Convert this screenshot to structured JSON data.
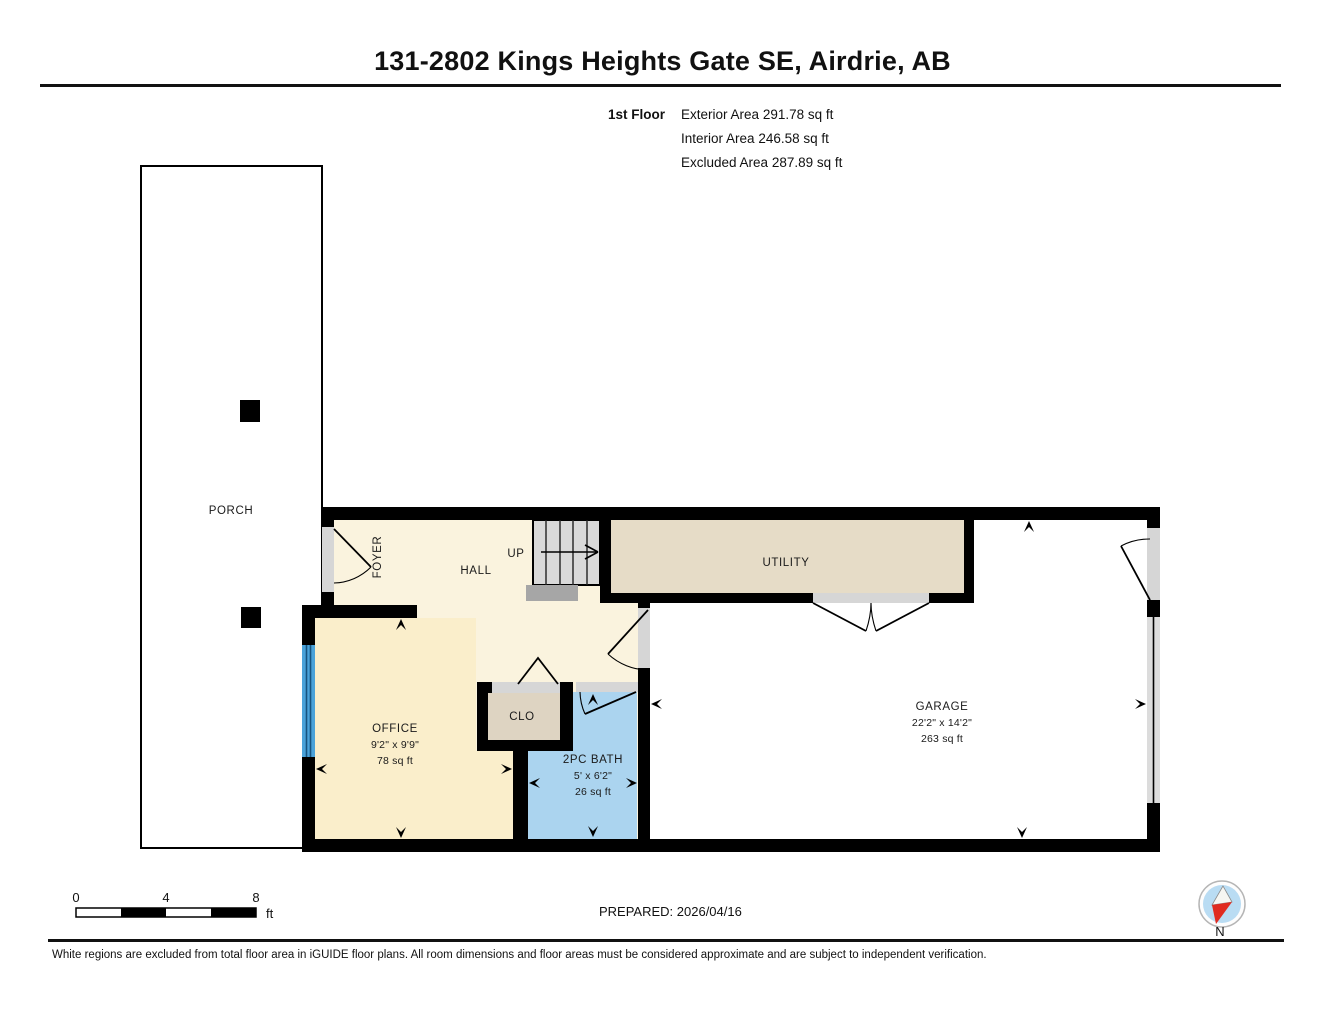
{
  "header": {
    "title": "131-2802 Kings Heights Gate SE, Airdrie, AB",
    "floor_label": "1st Floor",
    "areas": [
      {
        "label": "Exterior Area",
        "value": "291.78 sq ft"
      },
      {
        "label": "Interior Area",
        "value": "246.58 sq ft"
      },
      {
        "label": "Excluded Area",
        "value": "287.89 sq ft"
      }
    ]
  },
  "rooms": {
    "porch": {
      "name": "PORCH"
    },
    "foyer": {
      "name": "FOYER"
    },
    "hall": {
      "name": "HALL"
    },
    "stairs": {
      "direction": "UP"
    },
    "utility": {
      "name": "UTILITY"
    },
    "office": {
      "name": "OFFICE",
      "dims": "9'2\" x 9'9\"",
      "area": "78 sq ft"
    },
    "closet": {
      "name": "CLO"
    },
    "bath": {
      "name": "2PC BATH",
      "dims": "5' x 6'2\"",
      "area": "26 sq ft"
    },
    "garage": {
      "name": "GARAGE",
      "dims": "22'2\" x 14'2\"",
      "area": "263 sq ft"
    }
  },
  "scale_bar": {
    "ticks": [
      "0",
      "4",
      "8"
    ],
    "unit": "ft"
  },
  "prepared": {
    "label": "PREPARED: 2026/04/16"
  },
  "compass": {
    "label": "N"
  },
  "footer": {
    "disclaimer": "White regions are excluded from total floor area in iGUIDE floor plans. All room dimensions and floor areas must be considered approximate and are subject to independent verification."
  },
  "colors": {
    "wall": "#000000",
    "hall": "#faf3de",
    "office": "#faeecb",
    "utility": "#e6dcc7",
    "closet": "#ded4c2",
    "bath": "#abd4ef",
    "stairs": "#d9d9d9",
    "landing": "#a6a6a6",
    "window": "#4aa2d9",
    "door_jamb": "#d6d6d6",
    "garage_door": "#dcdcdc",
    "excluded": "#ffffff",
    "compass_disc": "#b9dcf3",
    "compass_north": "#e02b20"
  }
}
